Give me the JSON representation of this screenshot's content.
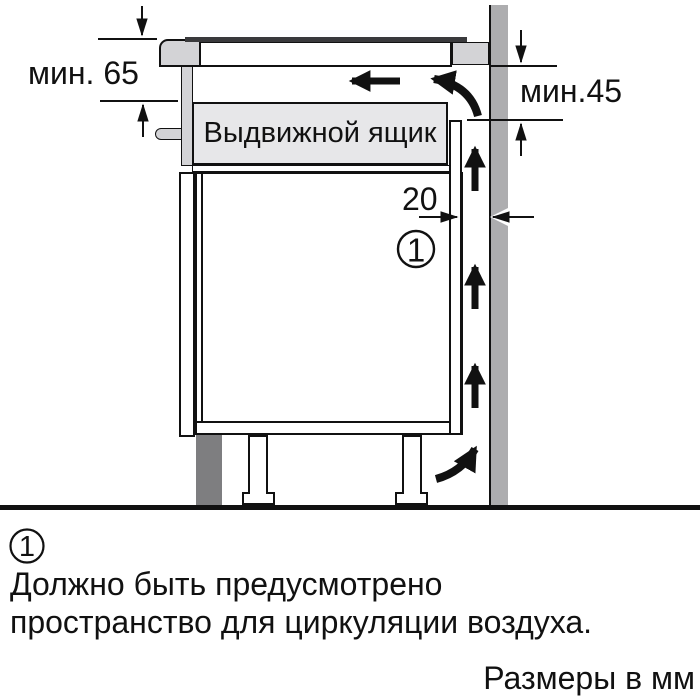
{
  "diagram": {
    "drawer_label": "Выдвижной ящик",
    "dim_min65": "мин. 65",
    "dim_min45": "мин.45",
    "dim_gap20": "20",
    "callout": "1"
  },
  "footnote": {
    "marker": "1",
    "line1": "Должно быть предусмотрено",
    "line2": "пространство для циркуляции воздуха.",
    "units": "Размеры в мм"
  },
  "colors": {
    "wall": "#adadaf",
    "plinth": "#7e7e80",
    "panel": "#d3d3d6",
    "drawer": "#e7e7e9",
    "glass": "#3a3a3c",
    "line": "#111111"
  }
}
